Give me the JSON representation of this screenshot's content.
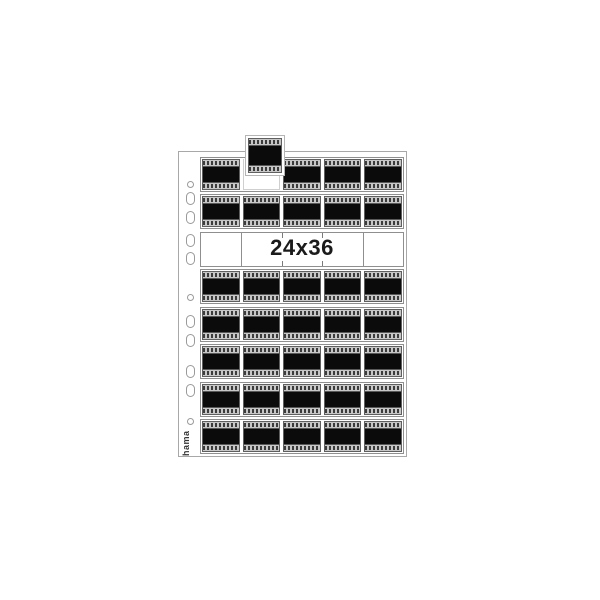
{
  "product": {
    "name": "Negative storage sleeve",
    "brand_logo": "hama",
    "format_label": "24x36"
  },
  "sheet": {
    "columns_per_row": 5,
    "rows": [
      {
        "type": "film",
        "frames": [
          "filled",
          "pulled-out",
          "filled",
          "filled",
          "filled"
        ]
      },
      {
        "type": "film",
        "frames": [
          "filled",
          "filled",
          "filled",
          "filled",
          "filled"
        ]
      },
      {
        "type": "label",
        "text": "24x36"
      },
      {
        "type": "film",
        "frames": [
          "filled",
          "filled",
          "filled",
          "filled",
          "filled"
        ]
      },
      {
        "type": "film",
        "frames": [
          "filled",
          "filled",
          "filled",
          "filled",
          "filled"
        ]
      },
      {
        "type": "film",
        "frames": [
          "filled",
          "filled",
          "filled",
          "filled",
          "filled"
        ]
      },
      {
        "type": "film",
        "frames": [
          "filled",
          "filled",
          "filled",
          "filled",
          "filled"
        ]
      },
      {
        "type": "film",
        "frames": [
          "filled",
          "filled",
          "filled",
          "filled",
          "filled"
        ]
      }
    ],
    "pulled_frame": {
      "row_index": 0,
      "column_index": 1
    },
    "label_band_dividers": [
      {
        "position_pct": 20,
        "style": "full-line"
      },
      {
        "position_pct": 40,
        "style": "tick"
      },
      {
        "position_pct": 60,
        "style": "tick"
      },
      {
        "position_pct": 80,
        "style": "full-line"
      }
    ],
    "binder_holes": [
      {
        "shape": "circle",
        "center_y": 32
      },
      {
        "shape": "oval",
        "center_y": 46
      },
      {
        "shape": "oval",
        "center_y": 65
      },
      {
        "shape": "oval",
        "center_y": 88
      },
      {
        "shape": "oval",
        "center_y": 106
      },
      {
        "shape": "circle",
        "center_y": 145
      },
      {
        "shape": "oval",
        "center_y": 169
      },
      {
        "shape": "oval",
        "center_y": 188
      },
      {
        "shape": "oval",
        "center_y": 219
      },
      {
        "shape": "oval",
        "center_y": 238
      },
      {
        "shape": "circle",
        "center_y": 269
      }
    ]
  },
  "colors": {
    "background": "#ffffff",
    "film_black": "#0b0b0b",
    "perf_band": "#c7c7c7",
    "perf_mark": "#3c3c3c",
    "cell_border": "#5f5f5f",
    "row_border": "#8f8f8f",
    "sheet_border": "#a8a8a8",
    "hole_border": "#9a9a9a",
    "label_text": "#1b1b1b",
    "brand_text": "#333333"
  }
}
